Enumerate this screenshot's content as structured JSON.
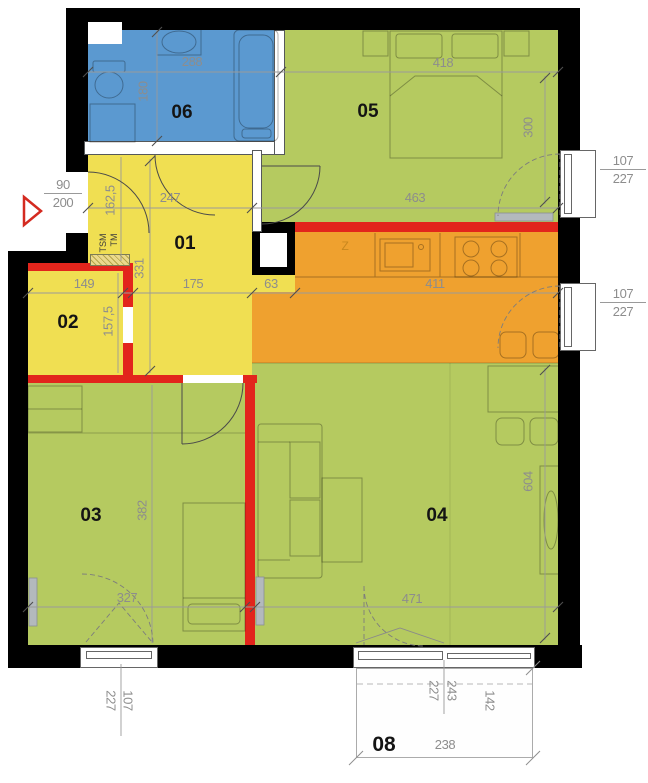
{
  "colors": {
    "bathroom_fill": "#5b99d0",
    "bedroom_fill": "#b5ca60",
    "hall_fill": "#f0df52",
    "kitchen_fill": "#efa12f",
    "new_wall": "#e2251c",
    "old_wall": "#000000",
    "dim_text": "#8d8d8d"
  },
  "rooms": {
    "hall": {
      "number": "01",
      "dim_top": "247",
      "dim_entry_wall": "162,5",
      "dim_height": "331",
      "dim_width": "175"
    },
    "wardrobe": {
      "number": "02",
      "dim_width": "149",
      "dim_height": "157,5"
    },
    "bedroom1": {
      "number": "03",
      "dim_height": "382",
      "dim_width": "327"
    },
    "living_room": {
      "number": "04",
      "dim_width": "471",
      "dim_height": "604"
    },
    "bedroom2": {
      "number": "05",
      "dim_bed_zone": "418",
      "dim_height": "300",
      "dim_width": "463"
    },
    "bathroom": {
      "number": "06",
      "dim_width": "288",
      "dim_height": "180"
    },
    "balcony": {
      "number": "08",
      "dim_depth_outer": "243",
      "dim_depth_inner": "227",
      "dim_side": "142",
      "dim_width": "238"
    },
    "kitchen": {
      "dim_shaft": "63",
      "dim_counter": "411",
      "appliance_label": "Z"
    }
  },
  "entrance": {
    "door_width": "90",
    "door_height": "200"
  },
  "windows": {
    "bedroom2_window": {
      "width": "107",
      "height": "227"
    },
    "kitchen_window": {
      "width": "107",
      "height": "227"
    },
    "bedroom1_window": {
      "width": "107",
      "height": "227"
    }
  },
  "laundry": {
    "washer": "TM",
    "dryer": "TSM"
  }
}
